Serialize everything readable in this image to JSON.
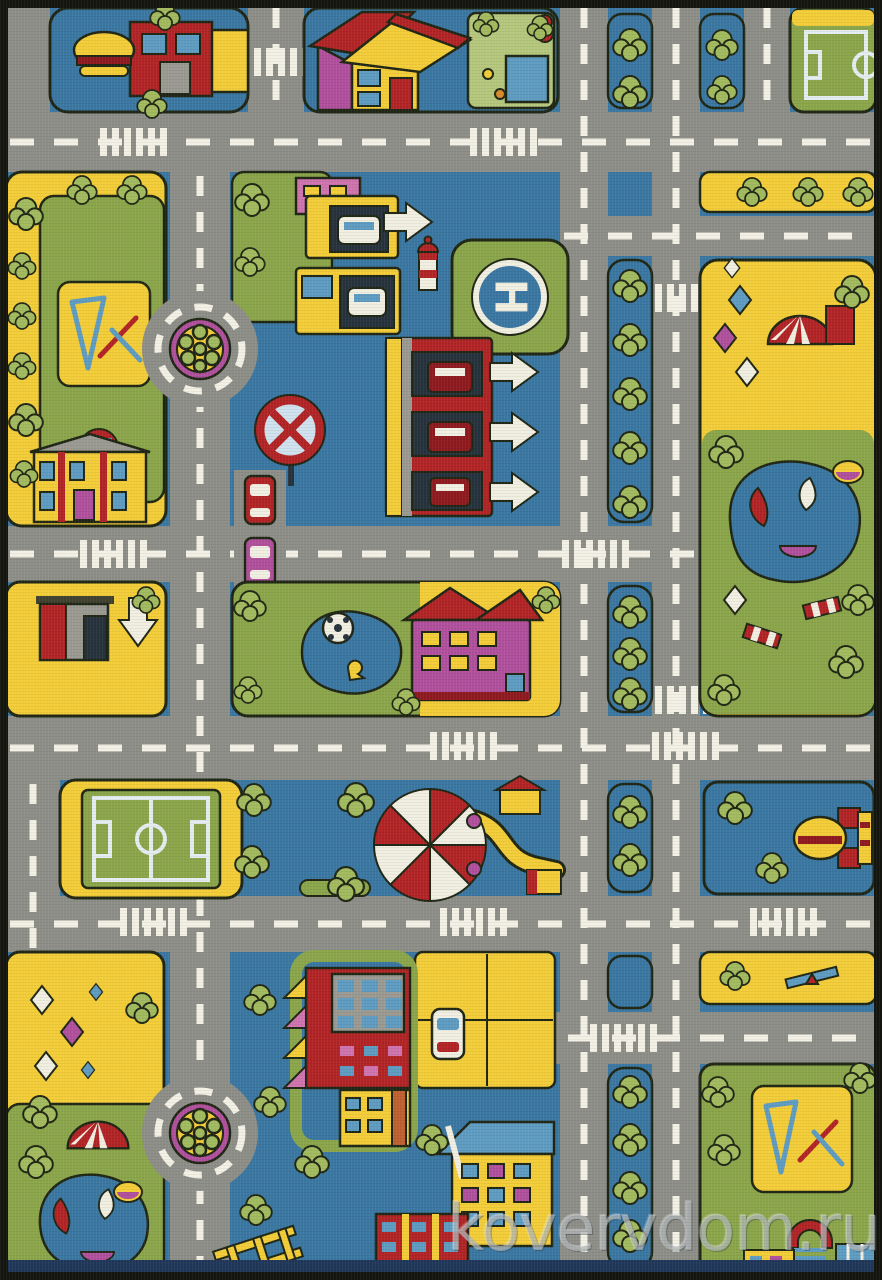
{
  "image": {
    "type": "product-photo",
    "subject": "children's play rug with toy city road-map design",
    "width_px": 882,
    "height_px": 1280
  },
  "watermark": {
    "text": "kovervdom.ru"
  },
  "helipad": {
    "letter": "H"
  },
  "palette": {
    "outline": "#202614",
    "water_blue": "#3a77a2",
    "road_gray": "#8e8e88",
    "road_line": "#f3f1e6",
    "block_yellow": "#f3cd38",
    "block_green": "#8ba64a",
    "garden_green": "#b5c77c",
    "tree_green": "#a2bb5e",
    "building_red": "#b22425",
    "dark_red": "#8e1a20",
    "magenta": "#b0509d",
    "pink": "#cf74ae",
    "white": "#f1eee2",
    "window_blue": "#5e9cc2",
    "building_gray": "#9a9a92",
    "black": "#15150f",
    "opening_dark": "#26323c",
    "brick_orange": "#c06030",
    "accent_orange": "#d88b2a",
    "rug_edge_navy": "#20375a",
    "pitch_line": "#e6edf0",
    "watermark_gray": "rgba(206,212,212,0.55)"
  },
  "scene": {
    "elements": [
      "gray road grid with white dashed markings",
      "pedestrian crosswalks",
      "tree-lined boulevard medians",
      "burger restaurant (top left)",
      "house with garden, pond and chickens",
      "toy bear",
      "soccer field (top right)",
      "roundabout with flower bed (top)",
      "playground with swings (left)",
      "school building with red arch (left)",
      "row of shops with cars",
      "multi-storey parking garage with cars",
      "white direction arrows",
      "helipad",
      "lighthouse",
      "no-stopping road sign",
      "three parked cars",
      "park with circus tent, kites and sailing-boat pond (right)",
      "gas station (left)",
      "kindergarten building and pond with soccer ball (center)",
      "soccer field (left)",
      "circus carousel big top (center)",
      "burger kiosk (right)",
      "park with kites and sailing-boat pond (bottom left)",
      "roundabout with flower bed (bottom)",
      "red building with awnings",
      "parking lot with car",
      "blue-roof house",
      "brick apartment block",
      "ladder toy",
      "seesaw",
      "playground with swings (bottom right)",
      "arch building (bottom right)"
    ]
  }
}
